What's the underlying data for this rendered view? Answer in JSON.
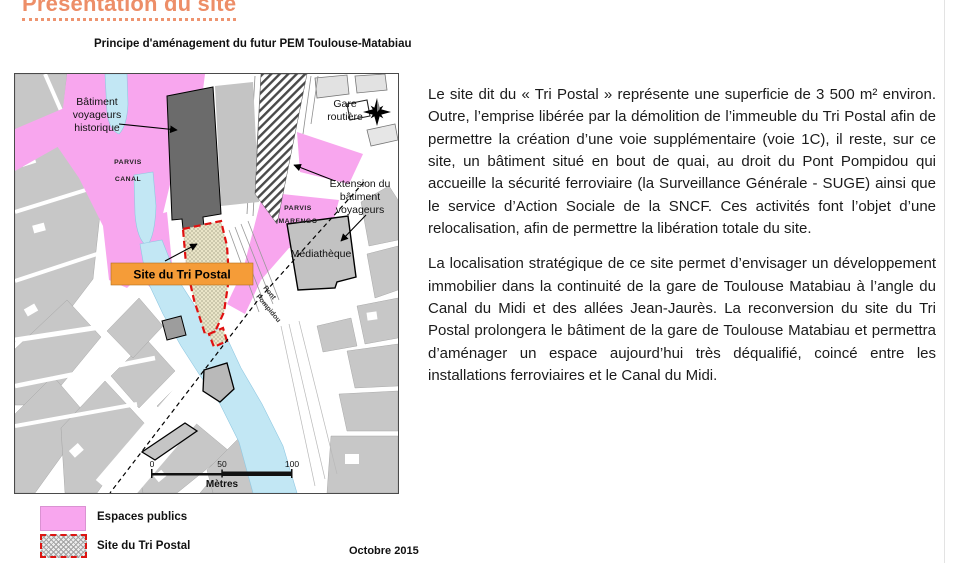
{
  "header": {
    "title": "Présentation du site"
  },
  "figure": {
    "caption": "Principe d'aménagement du futur PEM Toulouse-Matabiau"
  },
  "map": {
    "labels": {
      "batiment_voyageurs": [
        "Bâtiment",
        "voyageurs",
        "historique"
      ],
      "gare_routiere": [
        "Gare",
        "routière"
      ],
      "parvis_canal": [
        "PARVIS",
        "CANAL"
      ],
      "parvis_marengo": [
        "PARVIS",
        "MARENGO"
      ],
      "extension": [
        "Extension du",
        "bâtiment",
        "voyageurs"
      ],
      "mediatheque": "Médiathèque",
      "site_tri_postal": "Site du Tri Postal",
      "pont_pompidou": [
        "Pont",
        "Pompidou"
      ]
    },
    "scale": {
      "ticks": [
        "0",
        "50",
        "100"
      ],
      "unit": "Mètres"
    },
    "date": "Octobre 2015",
    "legend": {
      "espaces_publics": "Espaces publics",
      "site_tri_postal": "Site du Tri Postal"
    },
    "colors": {
      "public_space_pink": "#f8a6ee",
      "canal_blue": "#c2e7f4",
      "site_fill_beige": "#eae5c8",
      "site_border_red": "#e01010",
      "site_label_orange": "#f59c38",
      "station_dark_gray": "#6b6b6b",
      "heading_orange": "#ed8e68"
    }
  },
  "article": {
    "paragraphs": [
      "Le site dit du « Tri Postal » représente une superficie de 3 500 m² environ. Outre, l’emprise libérée par la démolition de l’immeuble du Tri Postal afin de permettre la création d’une voie supplémentaire (voie 1C), il reste, sur ce site, un bâtiment situé en bout de quai, au droit du Pont Pompidou qui accueille la sécurité ferroviaire (la Surveillance Générale - SUGE) ainsi que le service d’Action Sociale de la SNCF. Ces activités font l’objet d’une relocalisation, afin de permettre la libération totale du site.",
      "La localisation stratégique de ce site permet d’envisager un développement immobilier dans la continuité de la gare de Toulouse Matabiau à l’angle du Canal du Midi et des allées Jean-Jaurès. La reconversion du site du Tri Postal prolongera le bâtiment de la gare de Toulouse Matabiau et permettra d’aménager un espace aujourd’hui très déqualifié, coincé entre les installations ferroviaires et le Canal du Midi."
    ]
  }
}
